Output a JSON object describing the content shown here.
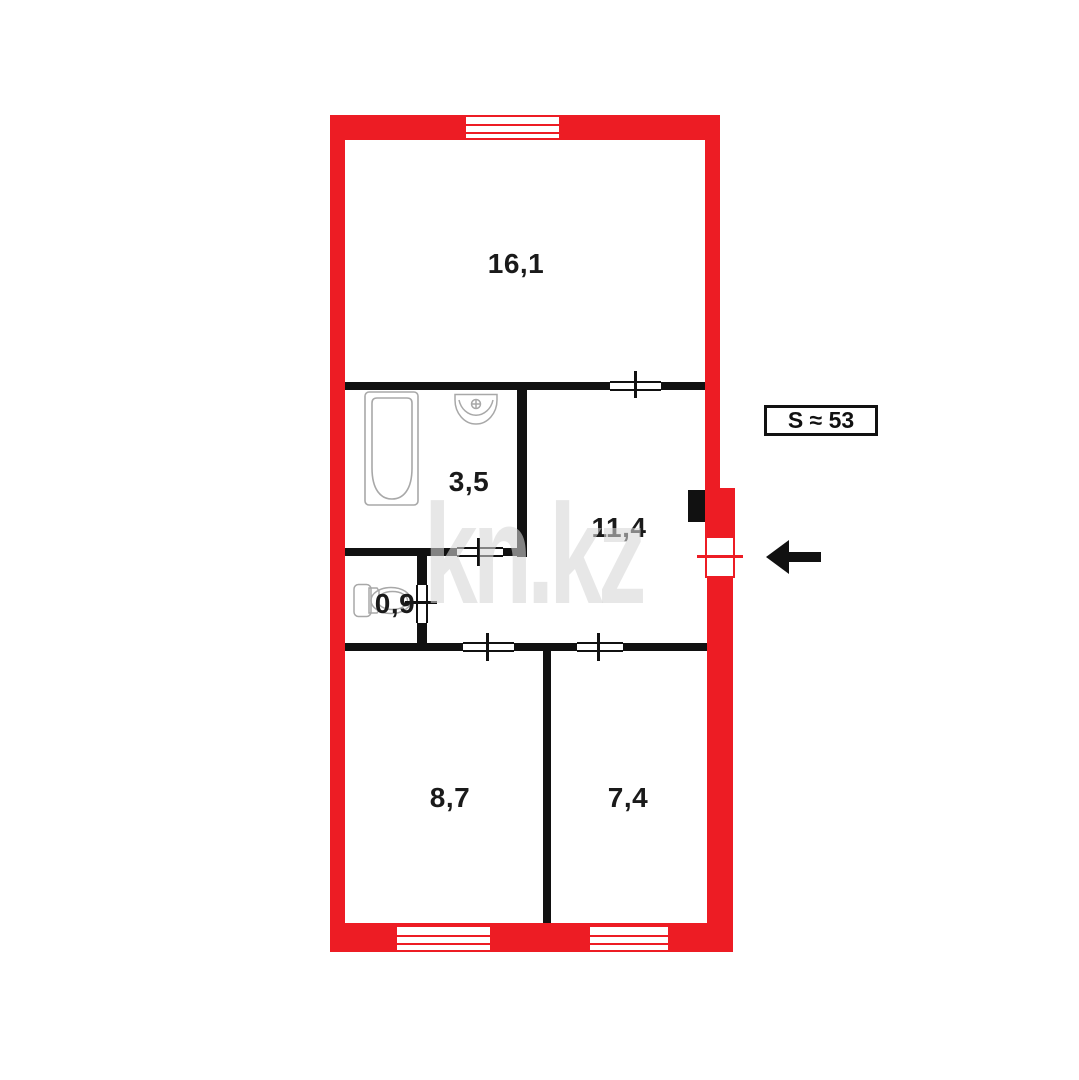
{
  "floor_plan": {
    "watermark": "kn.kz",
    "total_area_label": "S ≈ 53",
    "rooms": [
      {
        "area_label": "16,1"
      },
      {
        "area_label": "3,5"
      },
      {
        "area_label": "11,4"
      },
      {
        "area_label": "0,9"
      },
      {
        "area_label": "8,7"
      },
      {
        "area_label": "7,4"
      }
    ],
    "colors": {
      "exterior_wall": "#ED1C24",
      "interior_wall": "#111111",
      "fixture_outline": "#a8a8a8",
      "label_text": "#1a1a1a",
      "watermark_gray": "#d6d6d6"
    }
  }
}
